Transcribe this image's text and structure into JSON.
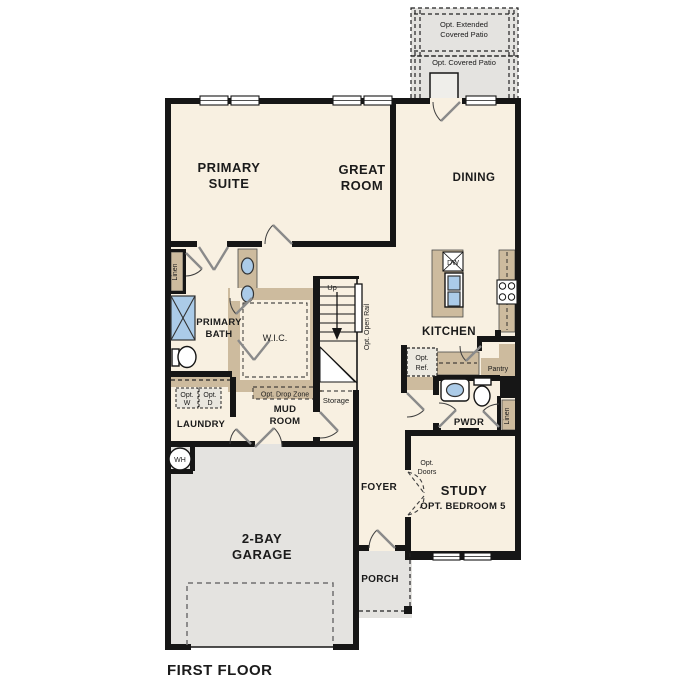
{
  "page_title": "FIRST FLOOR",
  "colors": {
    "floor": "#f8f0e1",
    "outdoor_gray": "#e4e3e0",
    "cabinet_tan": "#cdbb9e",
    "fixture_blue": "#abcbe8",
    "wall_black": "#161616",
    "door_gray": "#8a8a8a"
  },
  "rooms": {
    "primary_suite": {
      "line1": "PRIMARY",
      "line2": "SUITE"
    },
    "great_room": {
      "line1": "GREAT",
      "line2": "ROOM"
    },
    "dining": {
      "label": "DINING"
    },
    "kitchen": {
      "label": "KITCHEN"
    },
    "primary_bath": {
      "line1": "PRIMARY",
      "line2": "BATH"
    },
    "wic": {
      "label": "W.I.C."
    },
    "mud_room": {
      "line1": "MUD",
      "line2": "ROOM"
    },
    "laundry": {
      "label": "LAUNDRY"
    },
    "foyer": {
      "label": "FOYER"
    },
    "pwdr": {
      "label": "PWDR"
    },
    "study": {
      "label": "STUDY",
      "sub": "OPT. BEDROOM 5"
    },
    "garage": {
      "line1": "2-BAY",
      "line2": "GARAGE"
    },
    "porch": {
      "label": "PORCH"
    }
  },
  "features": {
    "opt_extended_patio": {
      "line1": "Opt. Extended",
      "line2": "Covered Patio"
    },
    "opt_covered_patio": {
      "label": "Opt. Covered Patio"
    },
    "linen_left": "Linen",
    "linen_right": "Linen",
    "stairs_up": "Up",
    "opt_open_rail": "Opt. Open Rail",
    "opt_drop_zone": "Opt. Drop Zone",
    "storage": "Storage",
    "opt_washer": {
      "line1": "Opt.",
      "line2": "W"
    },
    "opt_dryer": {
      "line1": "Opt.",
      "line2": "D"
    },
    "opt_ref": {
      "line1": "Opt.",
      "line2": "Ref."
    },
    "pantry": "Pantry",
    "dishwasher": "DW",
    "water_heater": "WH",
    "opt_doors": {
      "line1": "Opt.",
      "line2": "Doors"
    }
  }
}
